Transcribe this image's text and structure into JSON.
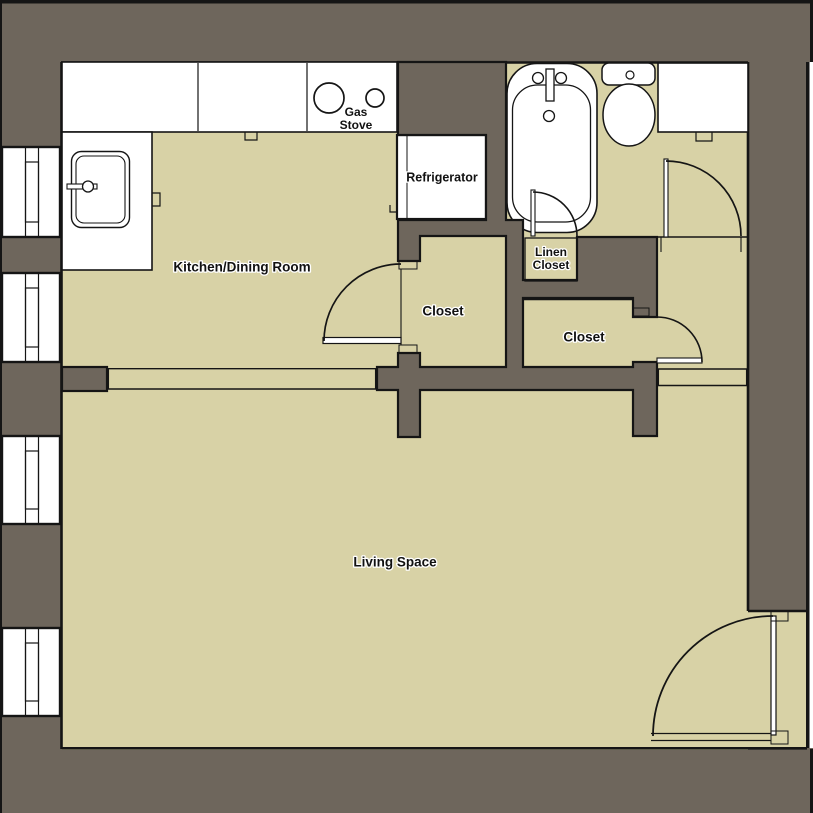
{
  "plan": {
    "rooms": {
      "kitchen": "Kitchen/Dining Room",
      "living": "Living Space",
      "closet_left": "Closet",
      "closet_right": "Closet",
      "linen_line1": "Linen",
      "linen_line2": "Closet"
    },
    "fixtures": {
      "stove_line1": "Gas",
      "stove_line2": "Stove",
      "refrigerator": "Refrigerator"
    },
    "colors": {
      "wall": "#6e665c",
      "floor": "#d8d2a6",
      "fixture_fill": "#ffffff",
      "line": "#151515"
    }
  }
}
